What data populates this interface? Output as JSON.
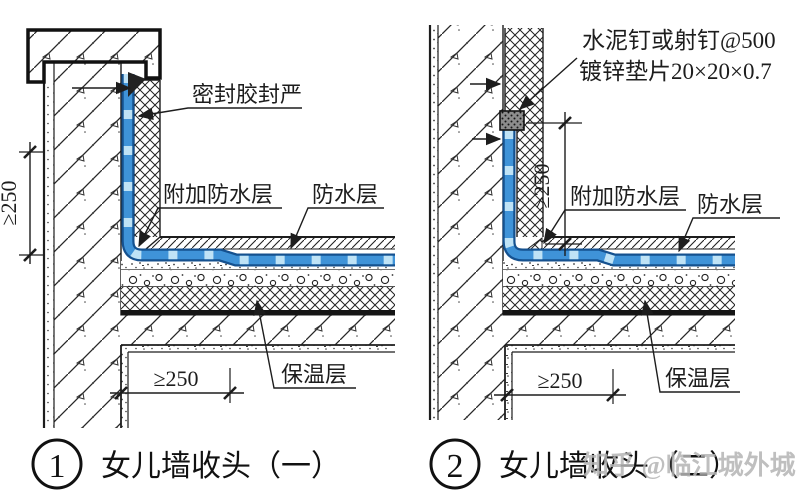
{
  "figure": {
    "background": "#ffffff",
    "line_color": "#1d1d1d"
  },
  "membrane": {
    "outline_color": "#15518f",
    "fill_color": "#3f93d8",
    "dash_color": "#bfe3f6"
  },
  "watermark": {
    "text": "知乎 @临江城外城",
    "color": "#b5b5b5"
  },
  "left": {
    "index": "1",
    "title": "女儿墙收头（一）",
    "labels": {
      "sealant": "密封胶封严",
      "extra_waterproof": "附加防水层",
      "waterproof": "防水层",
      "insulation": "保温层"
    },
    "dims": {
      "vertical": "≥250",
      "horizontal": "≥250"
    }
  },
  "right": {
    "index": "2",
    "title": "女儿墙收头（二）",
    "labels": {
      "nail": "水泥钉或射钉@500",
      "washer": "镀锌垫片20×20×0.7",
      "extra_waterproof": "附加防水层",
      "waterproof": "防水层",
      "insulation": "保温层"
    },
    "dims": {
      "vertical": "≥250",
      "horizontal": "≥250"
    }
  }
}
